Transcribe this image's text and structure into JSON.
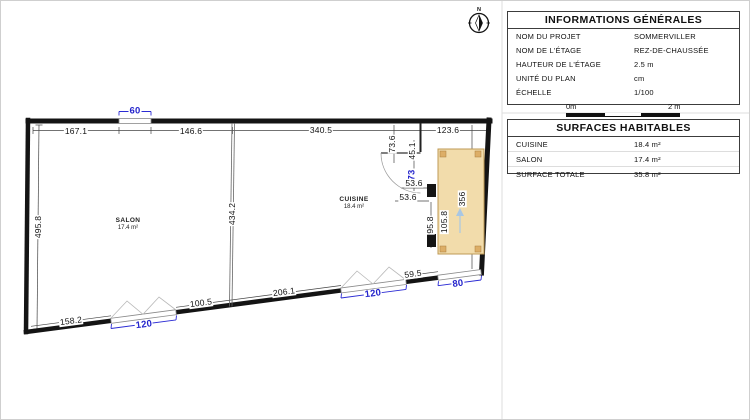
{
  "compass": {
    "label": "N"
  },
  "info_panel": {
    "title": "INFORMATIONS GÉNÉRALES",
    "rows": [
      {
        "label": "NOM DU PROJET",
        "value": "SOMMERVILLER"
      },
      {
        "label": "NOM DE L'ÉTAGE",
        "value": "REZ-DE-CHAUSSÉE"
      },
      {
        "label": "HAUTEUR DE L'ÉTAGE",
        "value": "2.5 m"
      },
      {
        "label": "UNITÉ DU PLAN",
        "value": "cm"
      },
      {
        "label": "ÉCHELLE",
        "value": "1/100"
      }
    ],
    "scale_bar": {
      "start": "0m",
      "end": "2 m"
    }
  },
  "surfaces_panel": {
    "title": "SURFACES HABITABLES",
    "rows": [
      {
        "label": "CUISINE",
        "value": "18.4 m²"
      },
      {
        "label": "SALON",
        "value": "17.4 m²"
      },
      {
        "label": "SURFACE TOTALE",
        "value": "35.8 m²"
      }
    ]
  },
  "plan": {
    "rooms": [
      {
        "name": "SALON",
        "area": "17.4 m²"
      },
      {
        "name": "CUISINE",
        "area": "18.4 m²"
      }
    ],
    "dims": {
      "top_1": "167.1",
      "top_2": "146.6",
      "top_3": "340.5",
      "top_4": "123.6",
      "left": "495.8",
      "partition": "434.2",
      "door_offset": "73.6",
      "door_side": "45.1",
      "door_width": "73",
      "counter_1": "53.6",
      "counter_2": "53.6",
      "counter_depth": "95.8",
      "counter_len": "105.8",
      "right_inner": "356",
      "bottom_1": "158.2",
      "bottom_2": "100.5",
      "bottom_3": "206.1",
      "bottom_4": "59.5",
      "win_top": "60",
      "win_bottom_1": "120",
      "win_bottom_2": "120",
      "win_bottom_3": "80"
    }
  }
}
